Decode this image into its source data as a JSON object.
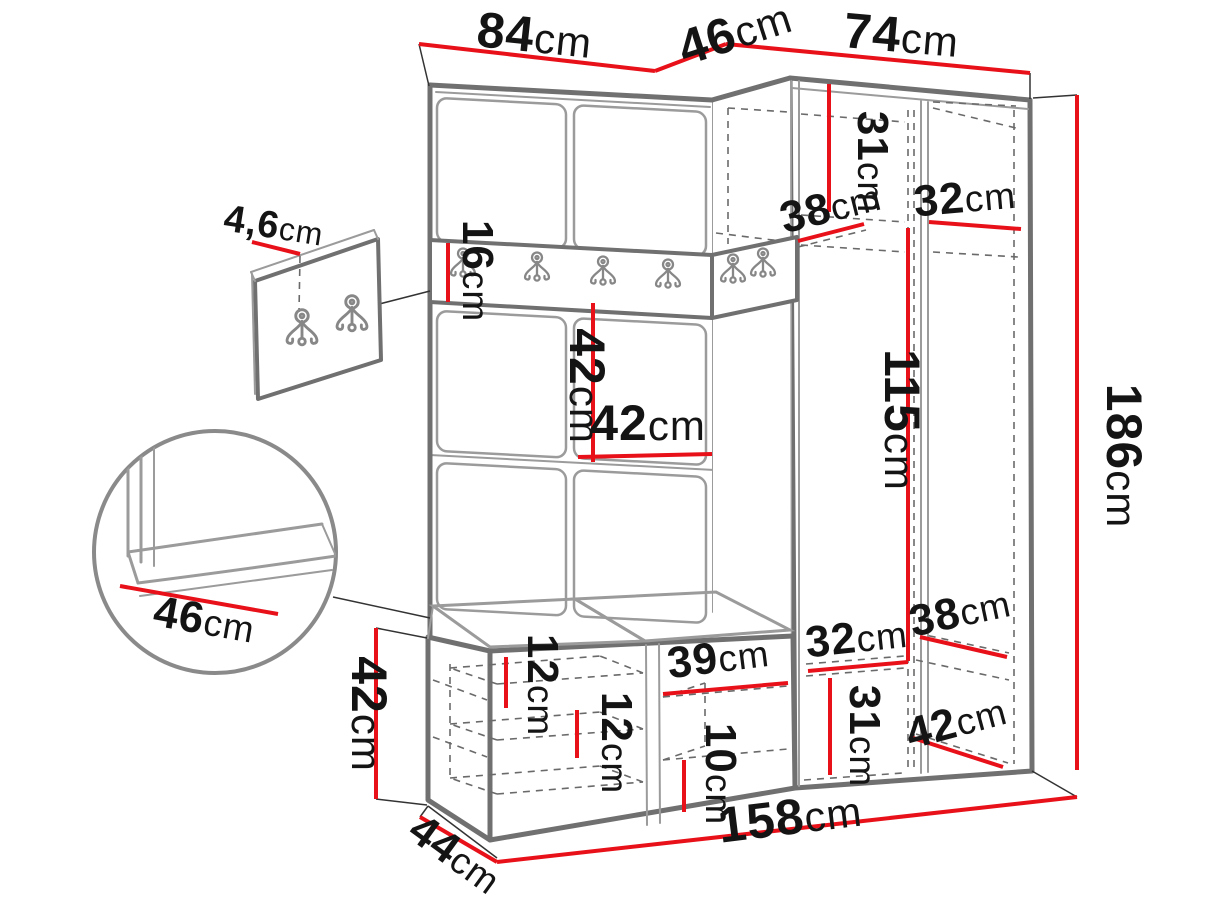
{
  "colors": {
    "dimension_line": "#e8111a",
    "outline_dark": "#707070",
    "outline_light": "#9b9b9b",
    "label": "#141414",
    "background": "#ffffff"
  },
  "dimensions": {
    "top_width_left": {
      "num": "84",
      "unit": "cm"
    },
    "top_width_corner": {
      "num": "46",
      "unit": "cm"
    },
    "top_width_right": {
      "num": "74",
      "unit": "cm"
    },
    "panel_thickness": {
      "num": "4,6",
      "unit": "cm"
    },
    "rail_height": {
      "num": "16",
      "unit": "cm"
    },
    "top_shelf_height": {
      "num": "31",
      "unit": "cm"
    },
    "corner_shelf_depth": {
      "num": "38",
      "unit": "cm"
    },
    "top_shelf_width": {
      "num": "32",
      "unit": "cm"
    },
    "panel_height": {
      "num": "42",
      "unit": "cm"
    },
    "panel_width": {
      "num": "42",
      "unit": "cm"
    },
    "hanging_height": {
      "num": "115",
      "unit": "cm"
    },
    "total_height": {
      "num": "186",
      "unit": "cm"
    },
    "seat_depth": {
      "num": "46",
      "unit": "cm"
    },
    "bench_height": {
      "num": "42",
      "unit": "cm"
    },
    "bench_gap_upper": {
      "num": "12",
      "unit": "cm"
    },
    "bench_gap_lower": {
      "num": "12",
      "unit": "cm"
    },
    "bench_shelf_width": {
      "num": "39",
      "unit": "cm"
    },
    "bench_bottom_gap": {
      "num": "10",
      "unit": "cm"
    },
    "lower_shelf_width": {
      "num": "32",
      "unit": "cm"
    },
    "lower_shelf_height": {
      "num": "31",
      "unit": "cm"
    },
    "lower_shelf_depth": {
      "num": "38",
      "unit": "cm"
    },
    "lower_bottom_depth": {
      "num": "42",
      "unit": "cm"
    },
    "unit_depth": {
      "num": "44",
      "unit": "cm"
    },
    "total_width": {
      "num": "158",
      "unit": "cm"
    }
  }
}
